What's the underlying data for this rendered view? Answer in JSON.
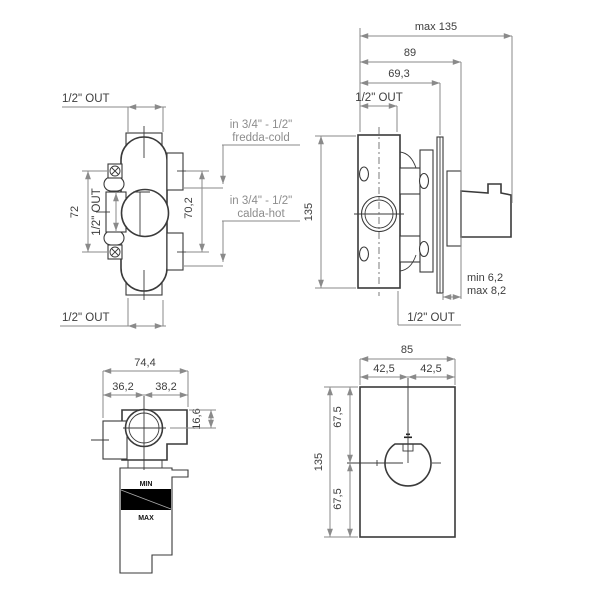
{
  "drawing_title": "thermostatic-concealed-mixer-dimensional-drawing",
  "colors": {
    "background": "#ffffff",
    "outline": "#3a3a3a",
    "dimension_line": "#8a8a8a",
    "dimension_text": "#3d3d3d",
    "secondary_label": "#8d8d8d",
    "plaster_band": "#000000"
  },
  "views": {
    "front": {
      "outlet_top": "1/2\" OUT",
      "outlet_bottom": "1/2\" OUT",
      "outlet_side": "1/2\" OUT",
      "screw_distance": "72",
      "inlet_distance": "70,2",
      "cold_spec": "in 3/4\" - 1/2\"",
      "cold_name": "fredda-cold",
      "hot_spec": "in 3/4\" - 1/2\"",
      "hot_name": "calda-hot"
    },
    "side": {
      "max_depth": "max 135",
      "depth_to_handle_base": "89",
      "depth_to_plate": "69,3",
      "outlet_top": "1/2\" OUT",
      "height": "135",
      "plate_gap_min": "min 6,2",
      "plate_gap_max": "max 8,2",
      "outlet_bottom": "1/2\" OUT"
    },
    "top": {
      "total_width": "74,4",
      "width_left": "36,2",
      "width_right": "38,2",
      "offset_depth": "16,6",
      "plaster_min": "MIN",
      "plaster_max": "MAX"
    },
    "plate": {
      "width": "85",
      "half_width_left": "42,5",
      "half_width_right": "42,5",
      "height": "135",
      "half_height_top": "67,5",
      "half_height_bottom": "67,5"
    }
  }
}
